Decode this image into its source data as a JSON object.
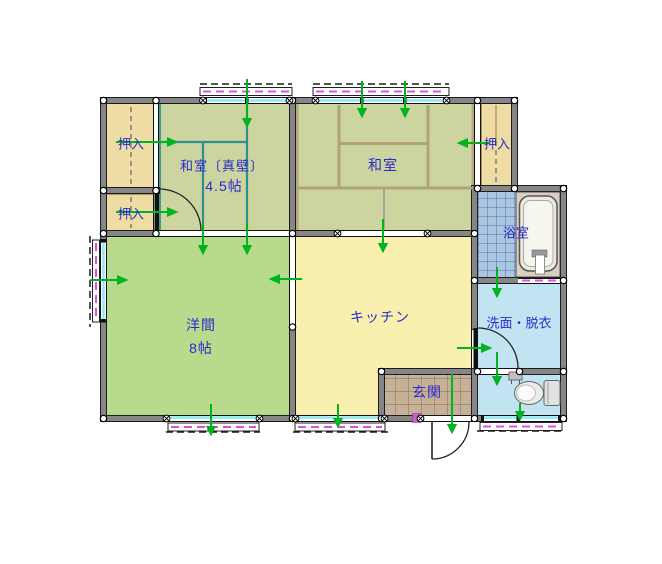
{
  "floorplan": {
    "rooms": [
      {
        "name": "oshiire-top-left",
        "label": "押入"
      },
      {
        "name": "oshiire-bottom-left",
        "label": "押入"
      },
      {
        "name": "oshiire-right",
        "label": "押入"
      },
      {
        "name": "washitsu-shinkabe",
        "label": "和室〔真壁〕",
        "size_label": "4.5帖"
      },
      {
        "name": "washitsu",
        "label": "和室"
      },
      {
        "name": "yoma",
        "label": "洋間",
        "size_label": "8帖"
      },
      {
        "name": "kitchen",
        "label": "キッチン"
      },
      {
        "name": "bathroom",
        "label": "浴室"
      },
      {
        "name": "washroom",
        "label": "洗面・脱衣"
      },
      {
        "name": "genkan",
        "label": "玄関"
      }
    ],
    "colors": {
      "wall": "#868686",
      "tatami": "#ccd4a0",
      "tatami_line_teal": "#2e8f8f",
      "tatami_line_tan": "#b0a476",
      "western_room": "#b7da8c",
      "kitchen": "#f9f0b0",
      "closet": "#eedca4",
      "entrance_tile": "#c6b098",
      "wet_area_blue": "#c2e4f2",
      "bath_tile": "#a9c7e1",
      "window_glass": "#8aeaf2",
      "shutter_dash_magenta": "#e050e0",
      "opening_marker_green": "#00b41e",
      "label_text": "#2a2acc"
    }
  }
}
